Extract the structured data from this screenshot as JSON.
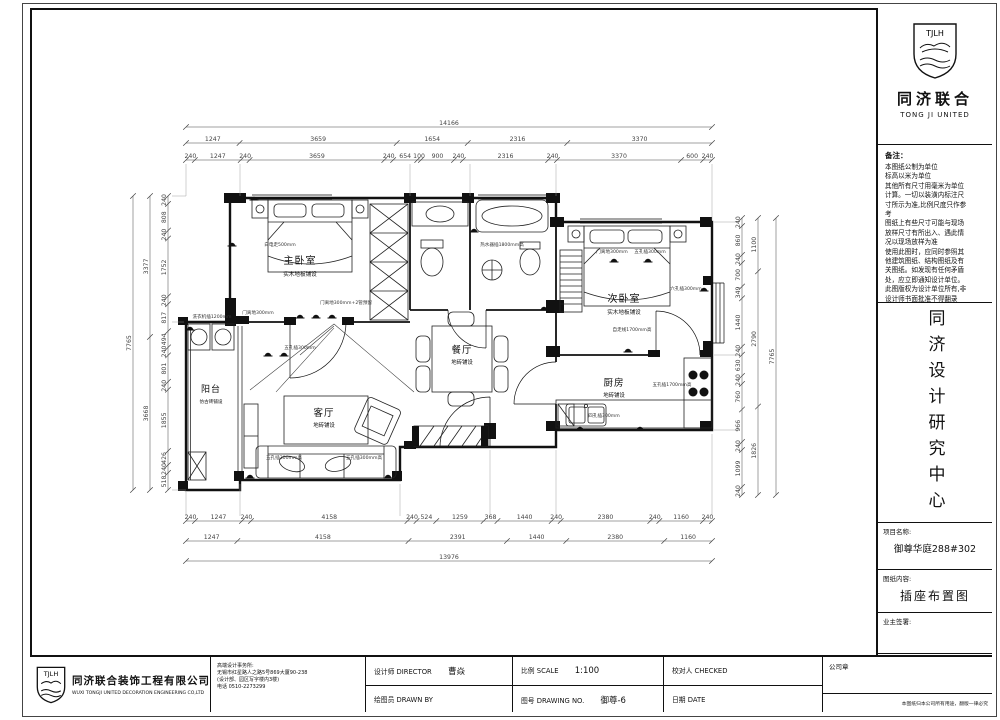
{
  "sheet": {
    "bg": "#ffffff",
    "line": "#111111",
    "dim_color": "#444444"
  },
  "logo": {
    "abbr": "TJLH",
    "cn": "同济联合",
    "en": "TONG JI UNITED"
  },
  "sidebar": {
    "notes_title": "备注：",
    "notes_lines": [
      "本图纸公制为单位",
      "标高以米为单位",
      "其他所有尺寸用毫米为单位",
      "计算。一切以装潢内标注尺",
      "寸所示为准,比例尺度只作参",
      "考",
      "图纸上有些尺寸可能与现场",
      "放样尺寸有所出入、遇此情",
      "况以现场放样为准",
      "使用此图时，应同时参照其",
      "他建筑图纸、结构图纸及有",
      "关图纸。如发现有任何矛盾",
      "处，应立即通知设计单位。",
      "此图版权为设计单位所有,非",
      "设计师书面批准不得翻录"
    ],
    "center_title": "同济设计研究中心",
    "project_label": "项目名称:",
    "project_name": "御尊华庭288#302",
    "content_label": "图纸内容:",
    "content_name": "插座布置图",
    "owner_label": "业主签署:"
  },
  "titlebar": {
    "company_cn": "同济联合装饰工程有限公司",
    "company_en": "WUXI TONGJI UNITED DECORATION ENGINEERING CO,LTD",
    "office_lines": [
      "高端设计事务所:",
      "无锡市红星路人之路5号869大厦90-238",
      "(设计部、园区写字楼内3楼)",
      "电话 0510-2273299"
    ],
    "director_label": "设计师 DIRECTOR",
    "director_value": "曹焱",
    "drawn_label": "绘图员 DRAWN BY",
    "scale_label": "比例 SCALE",
    "scale_value": "1:100",
    "no_label": "图号 DRAWING NO.",
    "no_value": "御尊-6",
    "checked_label": "校对人 CHECKED",
    "date_label": "日期 DATE",
    "seal_label": "公司章",
    "copyright": "本图纸归本公司所有用途，翻版一律必究"
  },
  "plan": {
    "rooms": {
      "master": {
        "name": "主卧室",
        "sub": "实木地板铺设"
      },
      "second": {
        "name": "次卧室",
        "sub": "实木地板铺设"
      },
      "dining": {
        "name": "餐厅",
        "sub": "地砖铺设"
      },
      "living": {
        "name": "客厅",
        "sub": "地砖铺设"
      },
      "kitchen": {
        "name": "厨房",
        "sub": "地砖铺设"
      },
      "balcony": {
        "name": "阳台",
        "sub": "仿古砖铺设"
      }
    },
    "annotations": [
      {
        "t": "白电走500mm",
        "x": 280,
        "y": 246
      },
      {
        "t": "门离地300mm",
        "x": 258,
        "y": 314
      },
      {
        "t": "门离地300mm+2管预留",
        "x": 346,
        "y": 304
      },
      {
        "t": "五孔插300mm",
        "x": 300,
        "y": 349
      },
      {
        "t": "门离地300mm",
        "x": 612,
        "y": 253
      },
      {
        "t": "五孔插300mm",
        "x": 650,
        "y": 253
      },
      {
        "t": "六孔插300mm",
        "x": 686,
        "y": 290
      },
      {
        "t": "自走线1700mm高",
        "x": 632,
        "y": 331
      },
      {
        "t": "五孔插1700mm高",
        "x": 672,
        "y": 386
      },
      {
        "t": "四孔插300mm",
        "x": 604,
        "y": 417
      },
      {
        "t": "五孔插300mm高",
        "x": 284,
        "y": 459
      },
      {
        "t": "五孔插300mm高",
        "x": 364,
        "y": 459
      },
      {
        "t": "洗衣机插1200mm",
        "x": 212,
        "y": 318
      },
      {
        "t": "热水器插1800mm高",
        "x": 502,
        "y": 246
      }
    ],
    "dims": {
      "top_total": [
        "14166"
      ],
      "top_mid": [
        "1247",
        "3659",
        "1654",
        "2316",
        "3370"
      ],
      "top_inner": [
        "240",
        "1247",
        "240",
        "3659",
        "240",
        "654",
        "100",
        "900",
        "240",
        "2316",
        "240",
        "3370",
        "600",
        "240"
      ],
      "bottom_inner": [
        "240",
        "1247",
        "240",
        "4158",
        "240",
        "524",
        "1259",
        "368",
        "1440",
        "240",
        "2380",
        "240",
        "1160",
        "240"
      ],
      "bottom_mid": [
        "1247",
        "4158",
        "2391",
        "1440",
        "2380",
        "1160"
      ],
      "bottom_total": [
        "13976"
      ],
      "left_inner": [
        "240",
        "808",
        "240",
        "1752",
        "240",
        "817",
        "494",
        "240",
        "801",
        "240",
        "1855",
        "426",
        "240",
        "518"
      ],
      "left_mid": [
        "3377",
        "3668"
      ],
      "left_total": [
        "7765"
      ],
      "right_inner": [
        "240",
        "860",
        "240",
        "700",
        "349",
        "1440",
        "240",
        "630",
        "240",
        "760",
        "966",
        "240",
        "1099",
        "240"
      ],
      "right_mid": [
        "1100",
        "2790",
        "1826"
      ],
      "right_total": [
        "7765"
      ]
    }
  }
}
